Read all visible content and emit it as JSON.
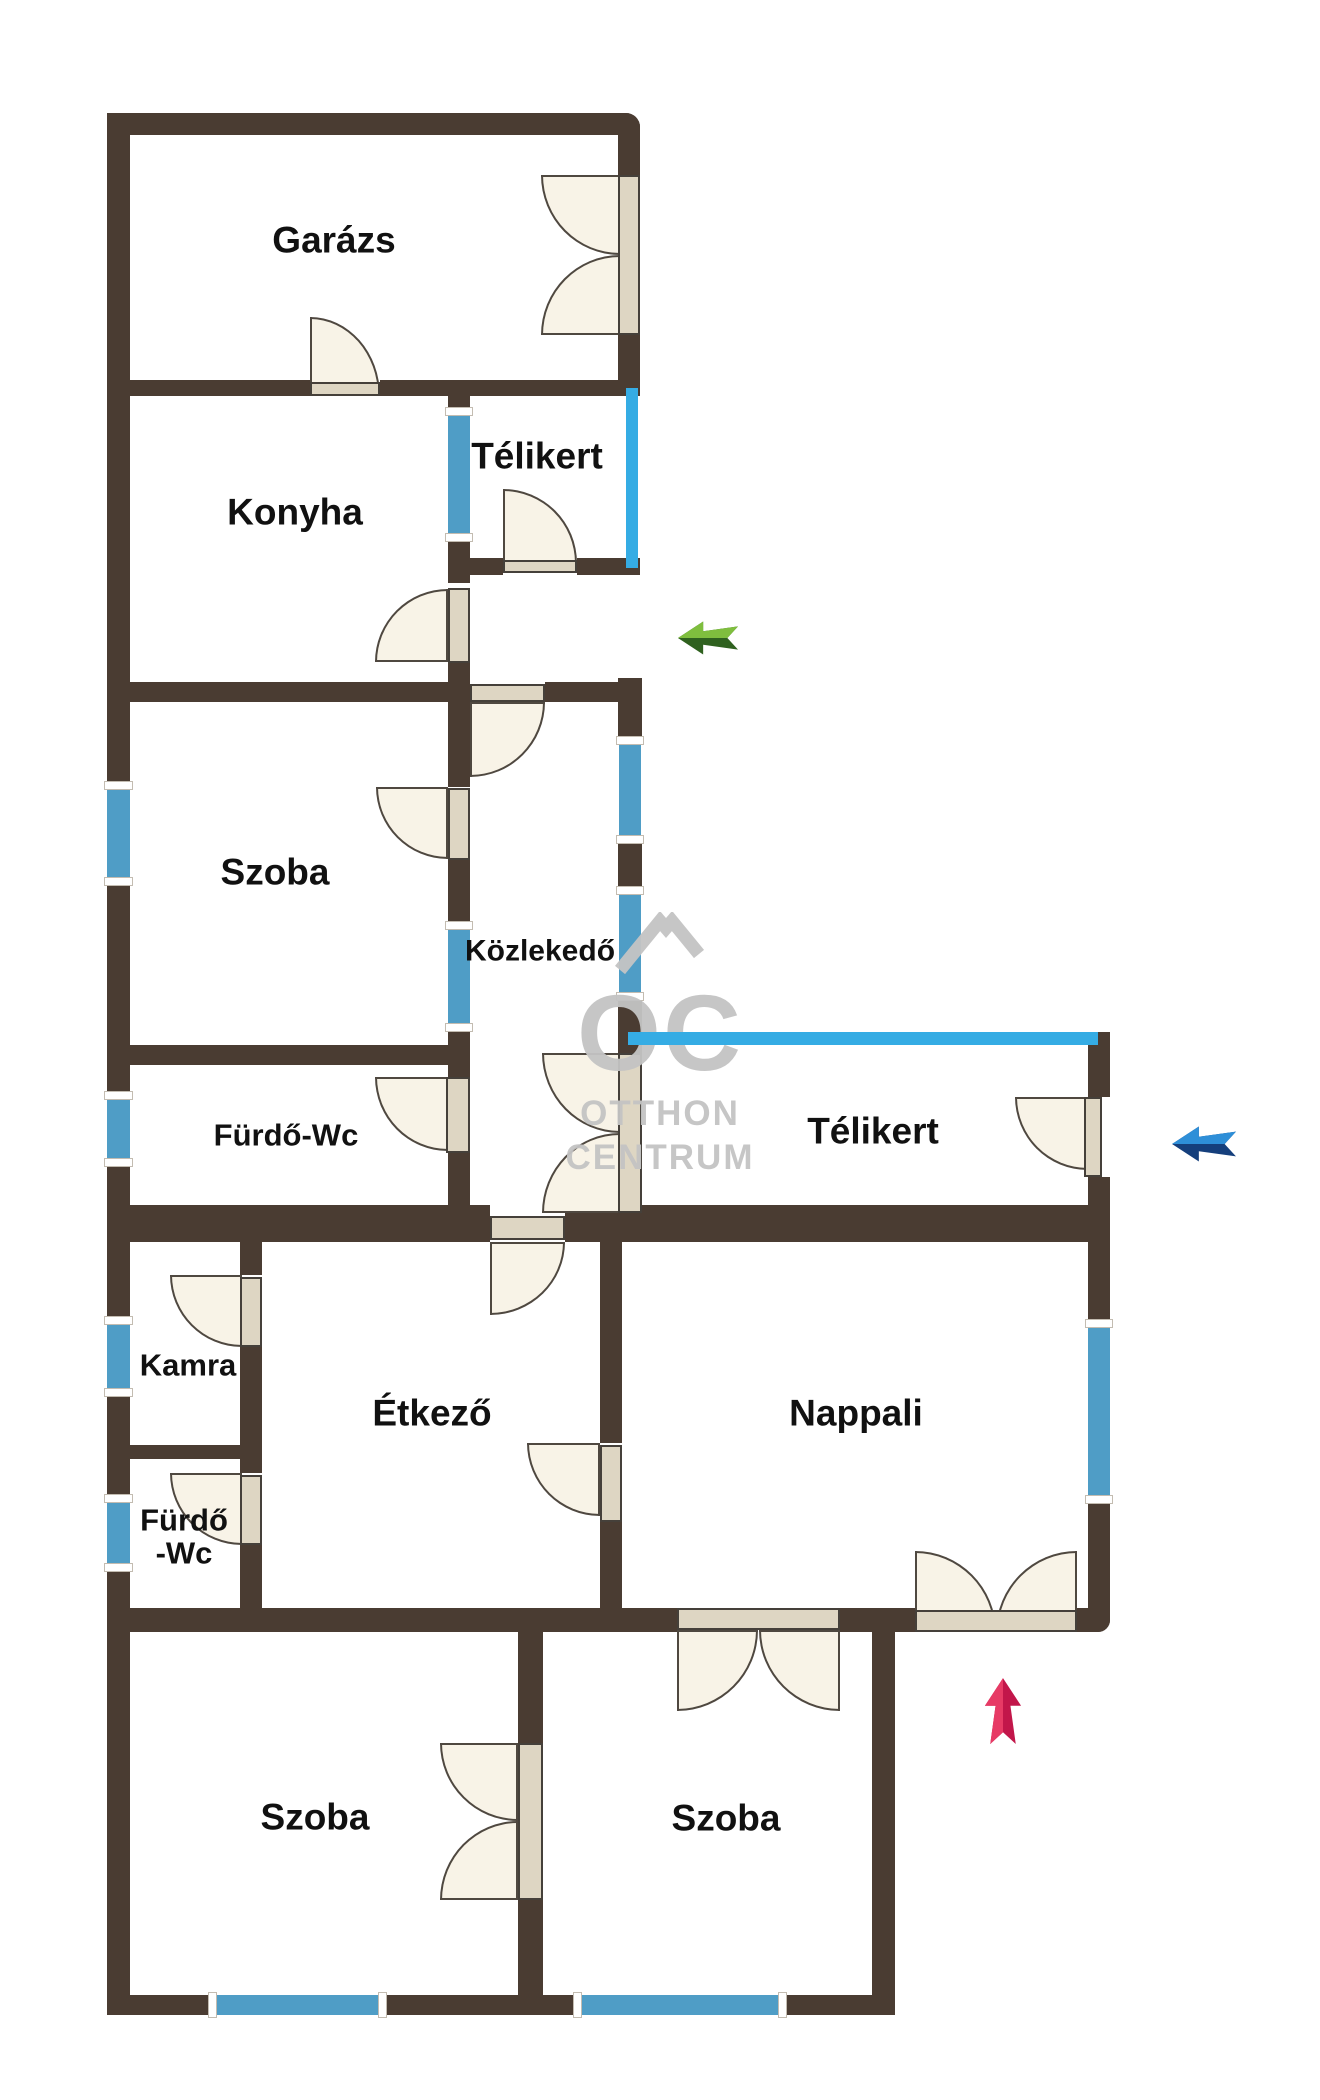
{
  "rooms": {
    "garazs": {
      "label": "Garázs"
    },
    "konyha": {
      "label": "Konyha"
    },
    "telikert_upper": {
      "label": "Télikert"
    },
    "szoba_upper": {
      "label": "Szoba"
    },
    "kozlekedo": {
      "label": "Közlekedő"
    },
    "furdo_wc_upper": {
      "label": "Fürdő-Wc"
    },
    "telikert_right": {
      "label": "Télikert"
    },
    "kamra": {
      "label": "Kamra"
    },
    "etkezo": {
      "label": "Étkező"
    },
    "nappali": {
      "label": "Nappali"
    },
    "furdo_wc_lower": {
      "label_line1": "Fürdő",
      "label_line2": "-Wc"
    },
    "szoba_bottom_left": {
      "label": "Szoba"
    },
    "szoba_bottom_right": {
      "label": "Szoba"
    }
  },
  "watermark": {
    "letters": "OC",
    "line1": "OTTHON",
    "line2": "CENTRUM"
  },
  "arrows": {
    "side_entrance": {
      "direction": "left",
      "color_light": "#7fbe3e",
      "color_dark": "#2f611f"
    },
    "telikert_entrance": {
      "direction": "left",
      "color_light": "#2e8fd8",
      "color_dark": "#153f7c"
    },
    "main_entrance": {
      "direction": "up",
      "color_light": "#e73a65",
      "color_dark": "#c2164a"
    }
  },
  "colors": {
    "wall": "#4a3c32",
    "window": "#4f9dc6",
    "glass": "#35ace4",
    "door_fill": "#f8f3e7",
    "door_leaf": "#ded6c3",
    "door_stroke": "#4f4840",
    "label": "#111111",
    "watermark": "#c4c4c4",
    "green_light": "#7fbe3e",
    "green_dark": "#2f611f",
    "blue_light": "#2e8fd8",
    "blue_dark": "#153f7c",
    "red_light": "#e73a65",
    "red_dark": "#c2164a"
  }
}
